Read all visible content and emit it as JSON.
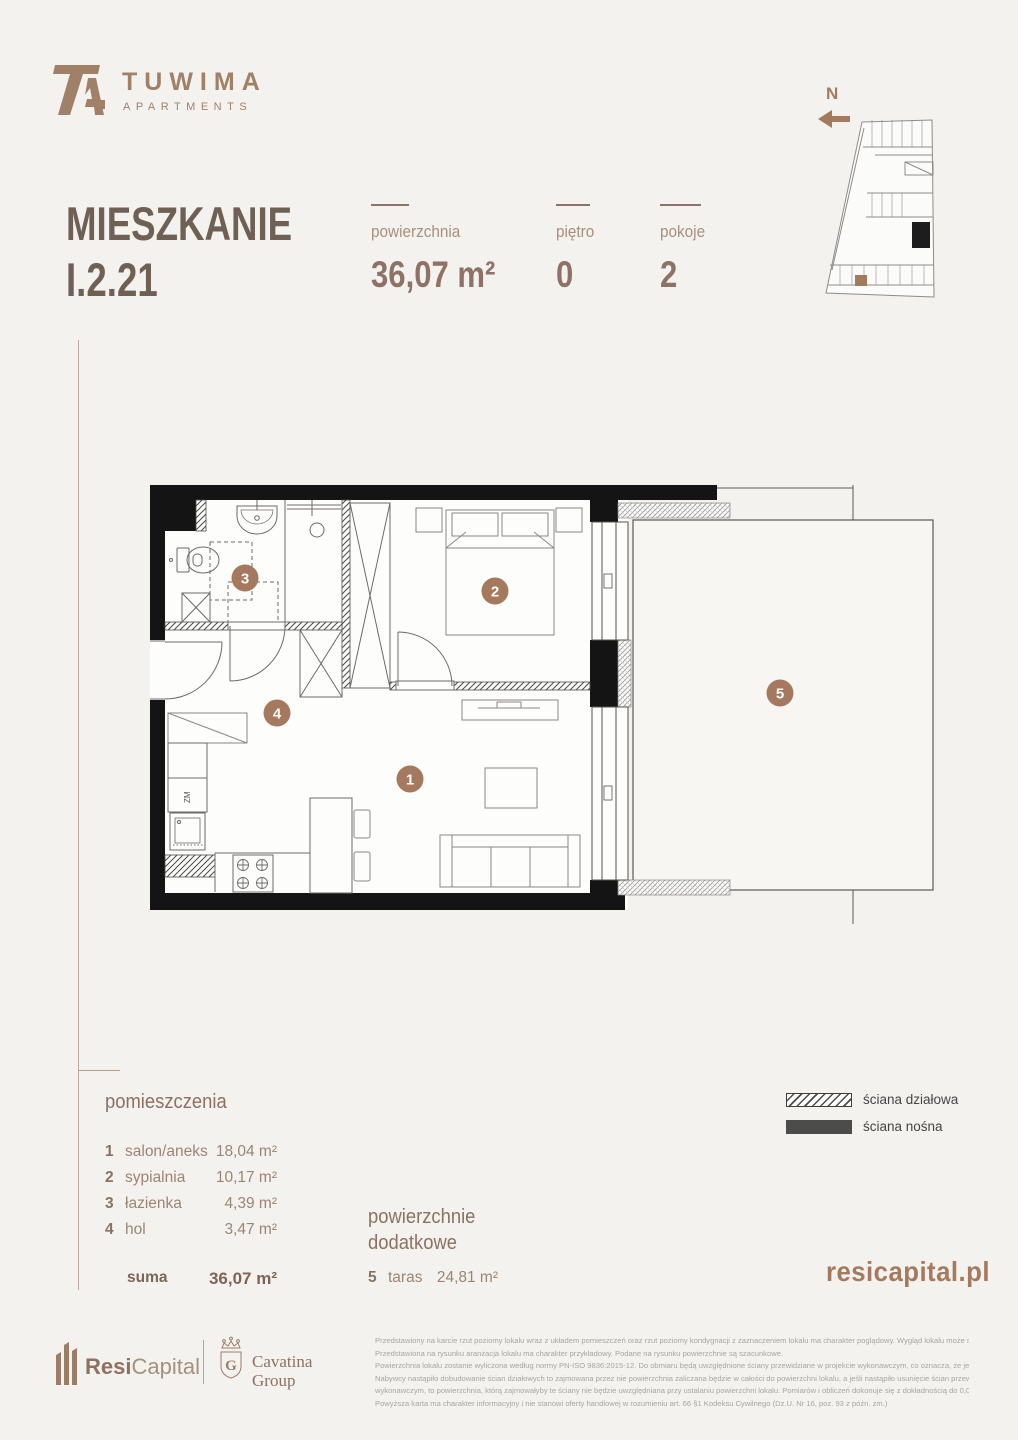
{
  "brand": {
    "name": "TUWIMA",
    "subtitle": "APARTMENTS"
  },
  "compass": {
    "north_label": "N"
  },
  "title": {
    "line1": "MIESZKANIE",
    "line2": "I.2.21"
  },
  "stats": {
    "area_label": "powierzchnia",
    "area_value": "36,07 m²",
    "floor_label": "piętro",
    "floor_value": "0",
    "rooms_label": "pokoje",
    "rooms_value": "2"
  },
  "plan": {
    "badge1": "1",
    "badge2": "2",
    "badge3": "3",
    "badge4": "4",
    "badge5": "5",
    "fridge_label": "ZM"
  },
  "rooms": {
    "header": "pomieszczenia",
    "items": [
      {
        "no": "1",
        "name": "salon/aneks",
        "area": "18,04 m²"
      },
      {
        "no": "2",
        "name": "sypialnia",
        "area": "10,17 m²"
      },
      {
        "no": "3",
        "name": "łazienka",
        "area": "4,39 m²"
      },
      {
        "no": "4",
        "name": "hol",
        "area": "3,47 m²"
      }
    ],
    "sum_label": "suma",
    "sum_value": "36,07 m²"
  },
  "additional": {
    "header": "powierzchnie dodatkowe",
    "items": [
      {
        "no": "5",
        "name": "taras",
        "area": "24,81 m²"
      }
    ]
  },
  "legend": {
    "partition_label": "ściana działowa",
    "bearing_label": "ściana nośna"
  },
  "website": "resicapital.pl",
  "footer": {
    "resi_bold": "Resi",
    "resi_light": "Capital",
    "cavatina_line1": "Cavatina",
    "cavatina_line2": "Group",
    "disclaimer": [
      "Przedstawiony na karcie rzut poziomy lokalu wraz z układem pomieszczeń oraz rzut poziomy kondygnacji z zaznaczeniem lokalu ma charakter poglądowy. Wygląd lokalu może nieznacznie ulec zmianie.",
      "Przedstawiona na rysunku aranżacja lokalu ma charakter przykładowy. Podane na rysunku powierzchnie są szacunkowe.",
      "Powierzchnia lokalu zostanie wyliczona według normy PN-ISO 9836:2015-12. Do obmiaru będą uwzględnione ściany przewidziane w projekcie wykonawczym, co oznacza, że jeżeli na życzenie",
      "Nabywcy nastąpiło dobudowanie ścian działowych to zajmowana przez nie powierzchnia zaliczana będzie w całości do powierzchni lokalu, a jeśli nastąpiło usunięcie ścian przewidzianych w projekcie",
      "wykonawczym, to powierzchnia, którą zajmowałyby te ściany nie będzie uwzględniana przy ustalaniu powierzchni lokalu. Pomiarów i obliczeń dokonuje się z dokładnością do 0,01 m2.",
      "Powyższa karta ma charakter informacyjny i nie stanowi oferty handlowej w rozumieniu art. 66 §1 Kodeksu Cywilnego (Dz.U. Nr 16, poz. 93 z późn. zm.)"
    ]
  },
  "colors": {
    "accent": "#a5795e",
    "title": "#6f6056",
    "wall": "#141414",
    "logo": "#a08066"
  }
}
